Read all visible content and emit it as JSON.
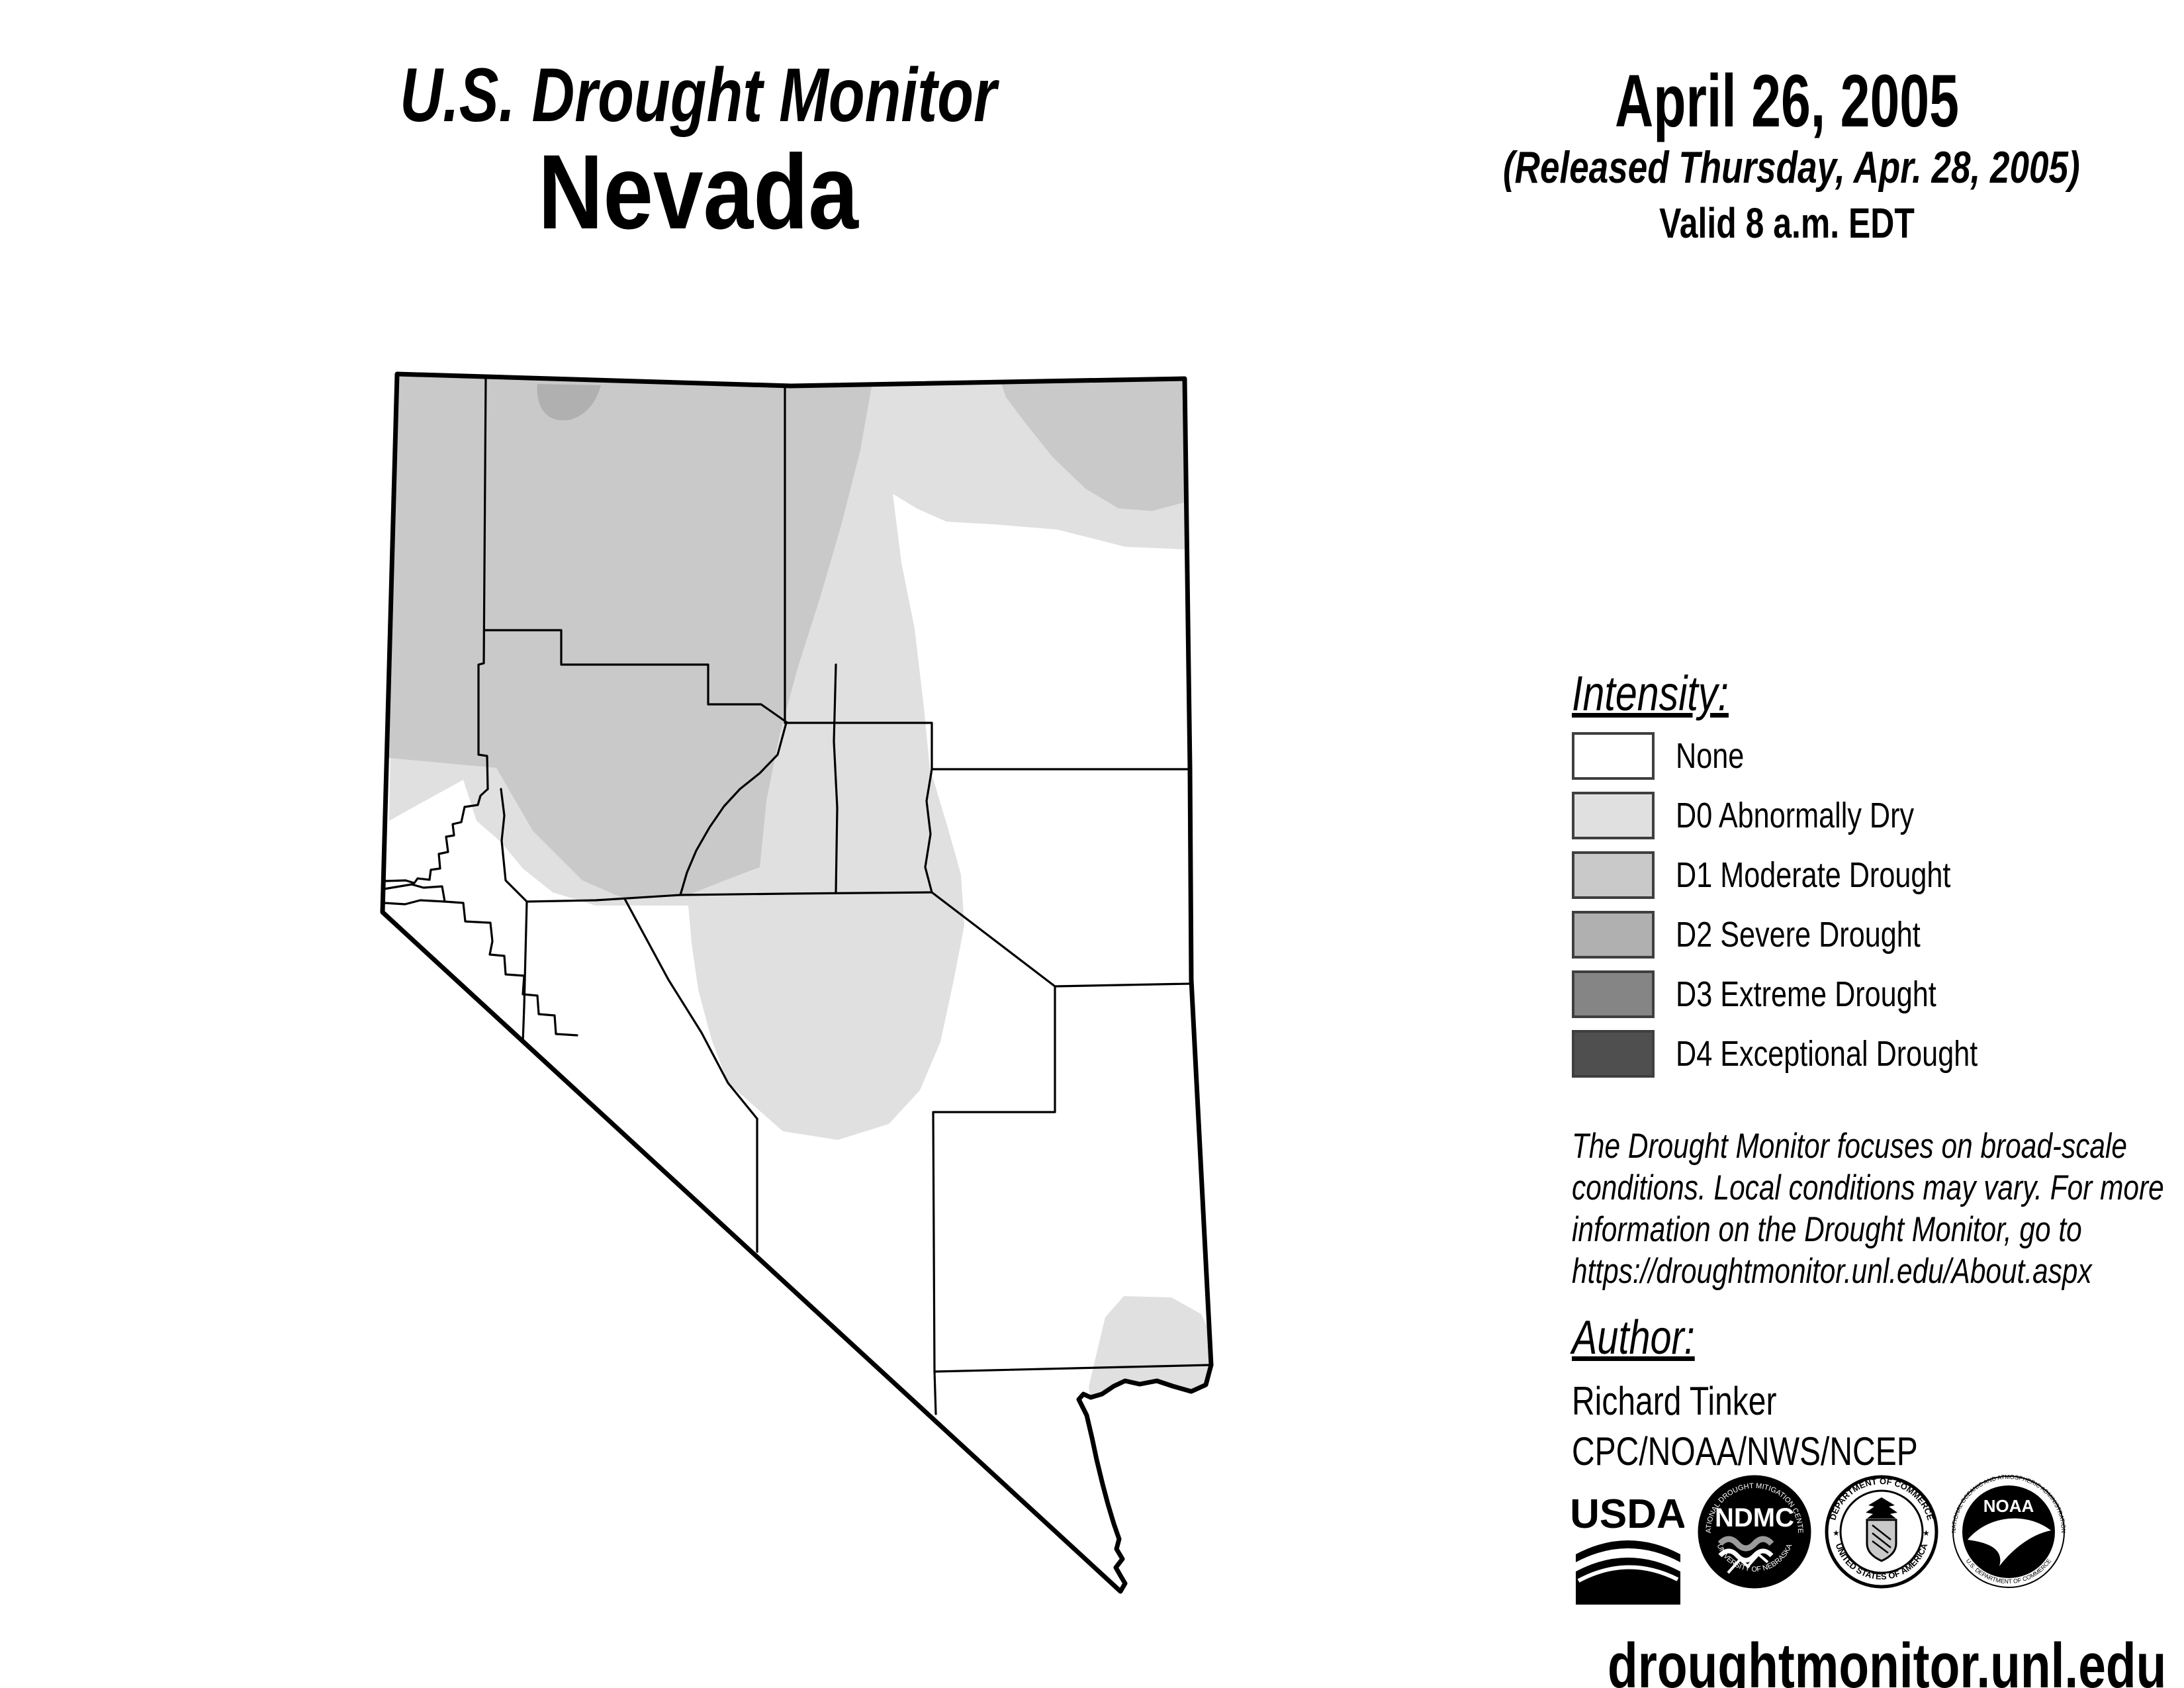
{
  "header": {
    "title": "U.S. Drought Monitor",
    "region": "Nevada"
  },
  "date_block": {
    "date": "April 26, 2005",
    "released": "(Released Thursday, Apr. 28, 2005)",
    "valid": "Valid 8 a.m. EDT"
  },
  "legend": {
    "heading": "Intensity:",
    "items": [
      {
        "code": "None",
        "label": "None",
        "color": "#ffffff"
      },
      {
        "code": "D0",
        "label": "D0 Abnormally Dry",
        "color": "#e0e0e0"
      },
      {
        "code": "D1",
        "label": "D1 Moderate Drought",
        "color": "#c9c9c9"
      },
      {
        "code": "D2",
        "label": "D2 Severe Drought",
        "color": "#b0b0b0"
      },
      {
        "code": "D3",
        "label": "D3 Extreme Drought",
        "color": "#858585"
      },
      {
        "code": "D4",
        "label": "D4 Exceptional Drought",
        "color": "#4f4f4f"
      }
    ]
  },
  "disclaimer": {
    "lines": [
      "The Drought Monitor focuses on broad-scale",
      "conditions. Local conditions may vary. For more",
      "information on the Drought Monitor, go to",
      "https://droughtmonitor.unl.edu/About.aspx"
    ]
  },
  "author_block": {
    "heading": "Author:",
    "name": "Richard Tinker",
    "org": "CPC/NOAA/NWS/NCEP"
  },
  "logos": {
    "usda": {
      "label": "USDA"
    },
    "ndmc": {
      "label": "NDMC",
      "ring_top": "NATIONAL DROUGHT MITIGATION CENTER",
      "ring_bottom": "UNIVERSITY OF NEBRASKA"
    },
    "doc": {
      "ring_top": "DEPARTMENT OF COMMERCE",
      "ring_bottom": "UNITED STATES OF AMERICA"
    },
    "noaa": {
      "label": "NOAA",
      "ring_top": "NATIONAL OCEANIC AND ATMOSPHERIC ADMINISTRATION",
      "ring_bottom": "U.S. DEPARTMENT OF COMMERCE"
    }
  },
  "footer": {
    "url": "droughtmonitor.unl.edu"
  },
  "map": {
    "state": "Nevada",
    "intensity_colors": {
      "none": "#ffffff",
      "D0": "#e0e0e0",
      "D1": "#c9c9c9",
      "D2": "#b0b0b0"
    }
  }
}
